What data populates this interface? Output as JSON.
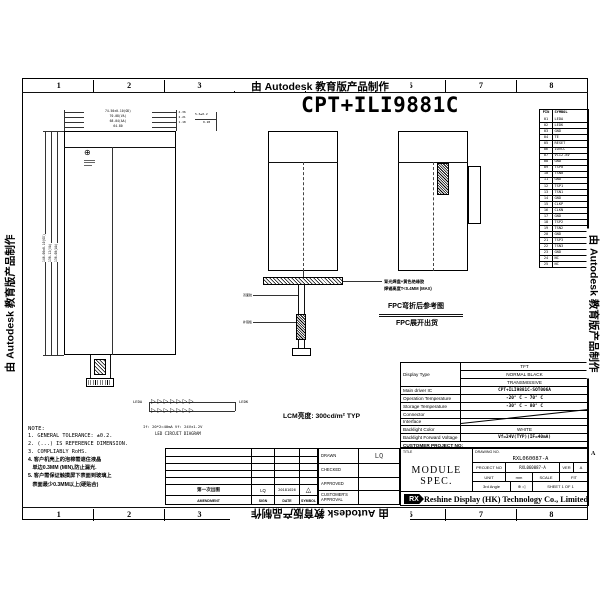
{
  "watermark": {
    "text": "由 Autodesk 教育版产品制作"
  },
  "zones": {
    "numbers": [
      "1",
      "2",
      "3",
      "4",
      "5",
      "6",
      "7",
      "8"
    ],
    "row_letter": "A"
  },
  "title": "CPT+ILI9881C",
  "icons": {
    "globe": "⊕",
    "third_angle": "⊕ ◁"
  },
  "pin_table": {
    "headers": [
      "PIN",
      "SYMBOL"
    ],
    "rows": [
      [
        "01",
        "LEDA"
      ],
      [
        "02",
        "LEDK"
      ],
      [
        "03",
        "GND"
      ],
      [
        "04",
        "TE"
      ],
      [
        "05",
        "RESET"
      ],
      [
        "06",
        "IOVCC"
      ],
      [
        "07",
        "VCI2.8V"
      ],
      [
        "08",
        "GND"
      ],
      [
        "09",
        "TSP0"
      ],
      [
        "10",
        "TSN0"
      ],
      [
        "11",
        "GND"
      ],
      [
        "12",
        "TSP1"
      ],
      [
        "13",
        "TSN1"
      ],
      [
        "14",
        "GND"
      ],
      [
        "15",
        "CLKP"
      ],
      [
        "16",
        "CLKN"
      ],
      [
        "17",
        "GND"
      ],
      [
        "18",
        "TSP2"
      ],
      [
        "19",
        "TSN2"
      ],
      [
        "20",
        "GND"
      ],
      [
        "21",
        "TSP3"
      ],
      [
        "22",
        "TSN3"
      ],
      [
        "23",
        "GND"
      ],
      [
        "24",
        "NC"
      ],
      [
        "25",
        "NC"
      ]
    ]
  },
  "dims": {
    "top": [
      "74.50±0.10(OD)",
      "70.08(VA)",
      "68.04(AA)",
      "64.80"
    ],
    "top_right": [
      "4.36",
      "2.21",
      "1.18"
    ],
    "left": [
      "146.06±0.10(OD)",
      "138.12(VA)",
      "136.08(AA)"
    ],
    "fpc": [
      "5.6±0.2",
      "0.28"
    ]
  },
  "fpc_view": {
    "solder_note_line1": "背光焊盘+黄色绝缘胶",
    "solder_note_line2": "焊锡高度T<0.4MM (MAX)",
    "bent_caption": "FPC弯折后参考图",
    "flat_caption": "FPC展开出货",
    "ann_tape": "双面胶",
    "ann_stiffener": "补强板"
  },
  "led_diagram": {
    "leda": "LEDA",
    "ledk": "LEDK",
    "row_glyphs": "▷▷▷▷▷▷▷",
    "spec_line": "If: 20*2=40mA   Vf: 24V±1.2V",
    "caption": "LED CIRCUIT DIAGRAM"
  },
  "brightness": "LCM亮度: 300cd/m²  TYP",
  "note": {
    "heading": "NOTE:",
    "lines_en": [
      "1. GENERAL TOLERANCE: ±0.2.",
      "2. (...) IS REFERENCE DIMENSION.",
      "3. COMPLIABLY RoHS."
    ],
    "lines_cn": [
      "4. 客户机壳上的泡棉需遮住液晶",
      "   单边0.3MM (MIN),防止漏光.",
      "5. 客户需保证触摸屏下表面到玻璃上",
      "   表面最少0.3MM以上(硬贴合)"
    ]
  },
  "revision": {
    "data_row": {
      "amendment": "第一次出图",
      "sign": "LQ",
      "date": "20181026",
      "symbol": "△",
      "symbol_num": "1"
    },
    "headers": {
      "amendment": "AMENDMENT",
      "sign": "SIGN",
      "date": "DATE",
      "symbol": "SYMBOL"
    }
  },
  "approval": {
    "rows": [
      {
        "label": "DRAWN",
        "value": "LQ"
      },
      {
        "label": "CHECKED",
        "value": ""
      },
      {
        "label": "APPROVED",
        "value": ""
      },
      {
        "label": "CUSTOMER'S APPROVAL",
        "value": ""
      }
    ]
  },
  "spec": {
    "display_type_label": "Display Type",
    "display_type_values": [
      "TFT",
      "NORMAL BLACK",
      "TRANSMISSIVE"
    ],
    "rows": [
      {
        "label": "Main driver IC",
        "value": "CPT+ILI9881C-SOT006A"
      },
      {
        "label": "Operation Temperature",
        "value": "-20° C ~ 70° C"
      },
      {
        "label": "Storage Temperature",
        "value": "-30° C ~ 80° C"
      },
      {
        "label": "Connector",
        "value": ""
      },
      {
        "label": "Interface",
        "value": ""
      },
      {
        "label": "Backlight Color",
        "value": "WHITE"
      },
      {
        "label": "Backlight Forward Voltage",
        "value": "Vf=24V(TYP)(IF=40mA)"
      }
    ],
    "customer_project_label": "CUSTOMER PROJECT NO:"
  },
  "title_block": {
    "title_label": "TITLE",
    "title": "MODULE  SPEC.",
    "drawing_no_label": "DRAWING NO.",
    "drawing_no": "RXL060087-A",
    "project_no_label": "PROJECT NO",
    "project_no": "RXL060087-A",
    "ver_label": "VER",
    "ver": "A",
    "unit_label": "UNIT",
    "unit": "mm",
    "scale_label": "SCALE",
    "scale": "FIT",
    "angle_label": "3rd Angle",
    "sheet": "SHEET 1 OF 1"
  },
  "company": {
    "logo": "RX",
    "name": "Reshine Display (HK) Technology Co., Limited"
  }
}
